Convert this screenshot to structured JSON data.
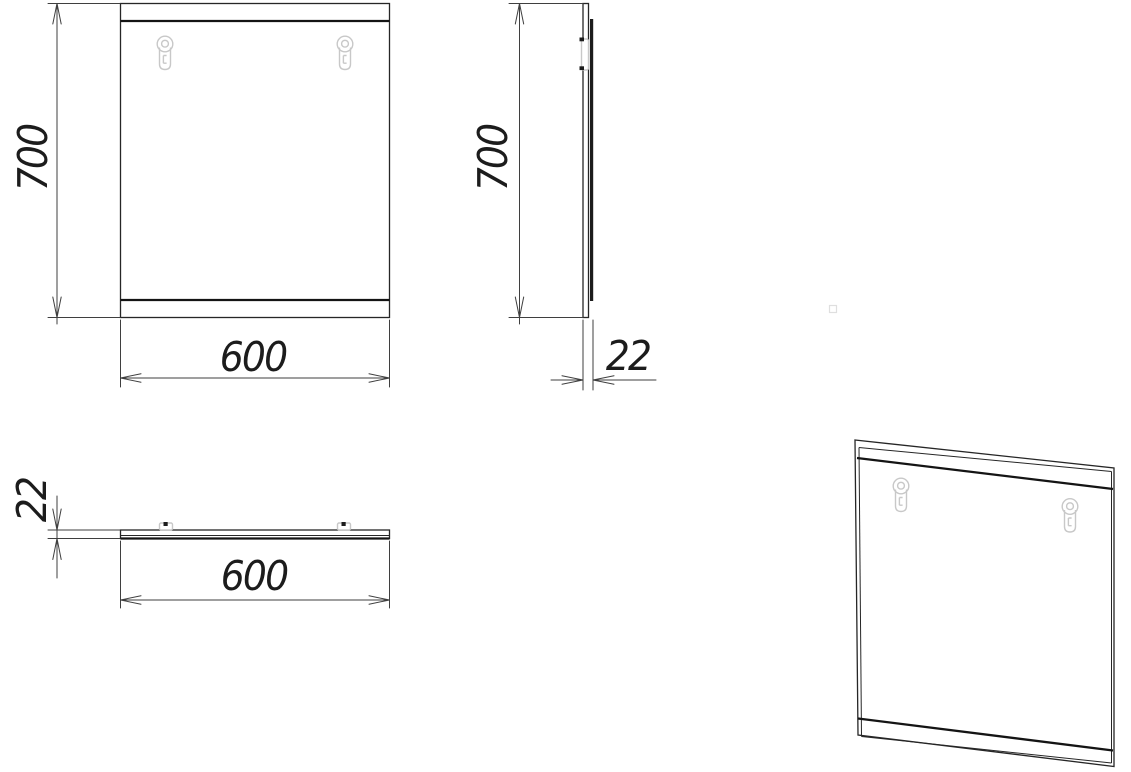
{
  "views": {
    "front": {
      "height_mm": "700",
      "width_mm": "600"
    },
    "side": {
      "height_mm": "700",
      "depth_mm": "22"
    },
    "top": {
      "depth_mm": "22",
      "width_mm": "600"
    }
  },
  "icons": {
    "mount_hardware": "keyhole-mount-icon"
  },
  "colors": {
    "object_line": "#262626",
    "heavy_line": "#141414",
    "dimension_line": "#3f3f3f",
    "hidden_hardware": "#c8c8c8",
    "background": "#ffffff"
  }
}
